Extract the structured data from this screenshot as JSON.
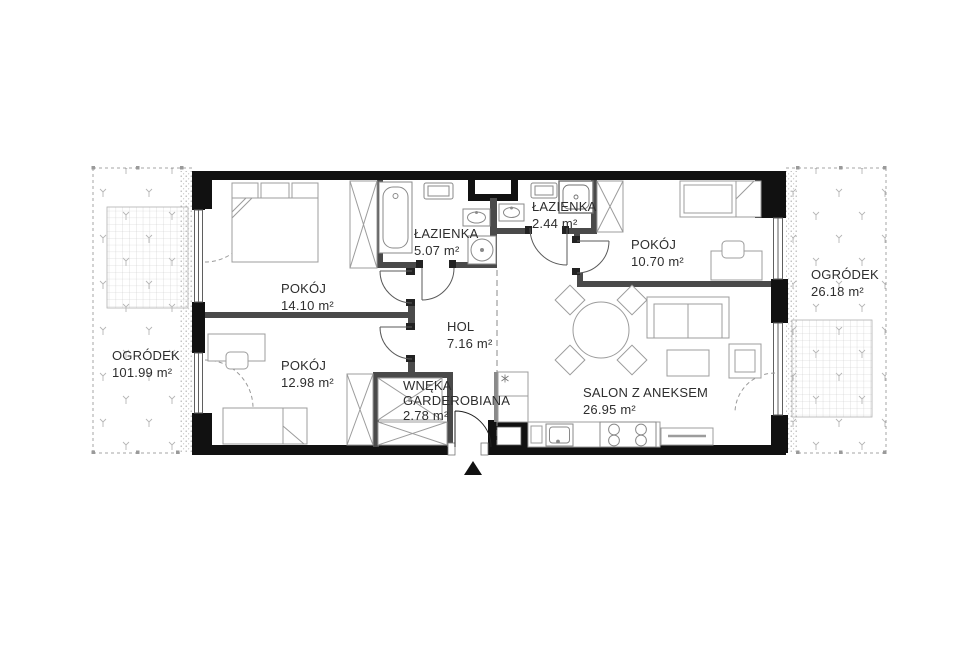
{
  "plan": {
    "type": "apartment-floor-plan",
    "colors": {
      "exterior_wall": "#111111",
      "interior_wall": "#4a4a4a",
      "furniture_stroke": "#9c9c9c",
      "fixture_stroke": "#8a8a8a",
      "label_text": "#2e2e2e",
      "garden_mark": "#b5b5b5",
      "door_arc": "#5a5a5a"
    }
  },
  "rooms": {
    "pokoj1": {
      "name": "POKÓJ",
      "area": "14.10 m²"
    },
    "pokoj2": {
      "name": "POKÓJ",
      "area": "12.98 m²"
    },
    "pokoj3": {
      "name": "POKÓJ",
      "area": "10.70 m²"
    },
    "lazienka1": {
      "name": "ŁAZIENKA",
      "area": "5.07 m²"
    },
    "lazienka2": {
      "name": "ŁAZIENKA",
      "area": "2.44 m²"
    },
    "hol": {
      "name": "HOL",
      "area": "7.16 m²"
    },
    "wneka": {
      "name_line1": "WNĘKA",
      "name_line2": "GARDEROBIANA",
      "area": "2.78 m²"
    },
    "salon": {
      "name": "SALON Z ANEKSEM",
      "area": "26.95 m²"
    }
  },
  "gardens": {
    "left": {
      "name": "OGRÓDEK",
      "area": "101.99 m²"
    },
    "right": {
      "name": "OGRÓDEK",
      "area": "26.18 m²"
    }
  }
}
